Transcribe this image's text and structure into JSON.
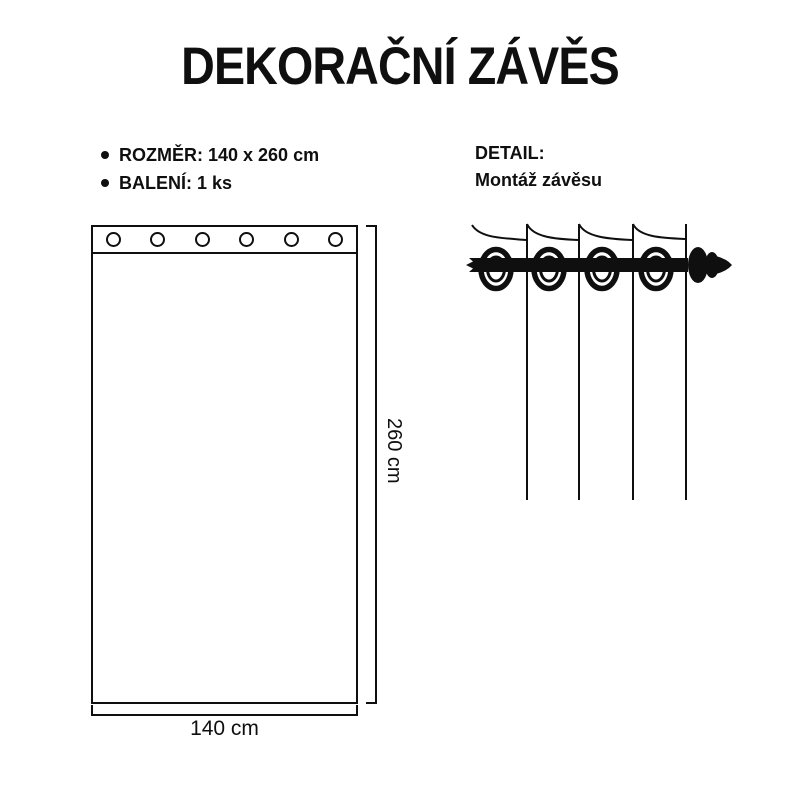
{
  "title": "DEKORAČNÍ ZÁVĚS",
  "specs": {
    "items": [
      {
        "label": "ROZMĚR: 140 x 260 cm"
      },
      {
        "label": "BALENÍ: 1 ks"
      }
    ]
  },
  "detail": {
    "heading": "DETAIL:",
    "subheading": "Montáž závěsu"
  },
  "diagram": {
    "width_label": "140 cm",
    "height_label": "260 cm",
    "grommet_count": 6,
    "detail_fold_count": 4,
    "detail_ring_count": 4
  },
  "colors": {
    "ink": "#0f0f0f",
    "background": "#ffffff"
  }
}
